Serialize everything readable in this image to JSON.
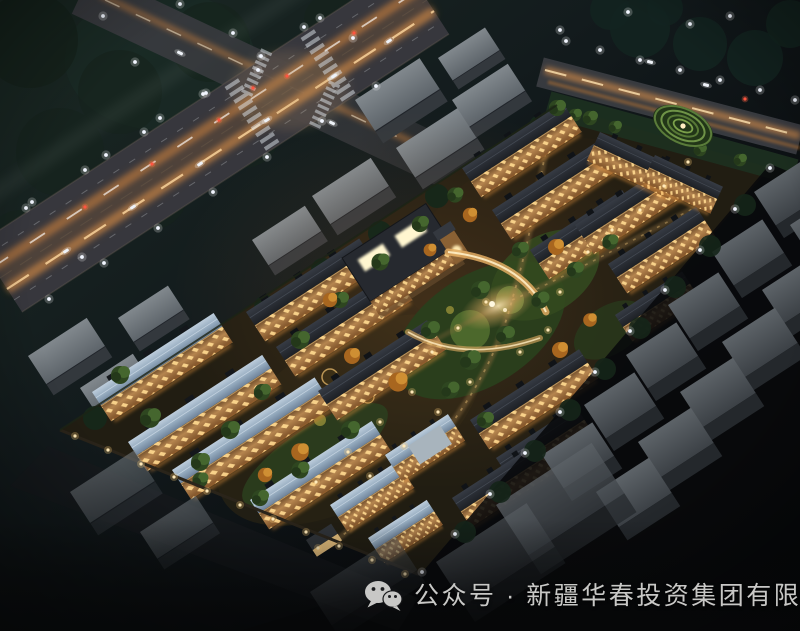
{
  "image_type": "aerial night-time architectural rendering (bird's-eye view) of a residential community",
  "watermark": {
    "icon": "wechat-icon",
    "text": "公众号 · 新疆华春投资集团有限公司",
    "text_color": "#c8c8c6"
  },
  "palette": {
    "watermark_color": "#c8c8c6",
    "sky_top": "#1b2a24",
    "sky_mid": "#121a1c",
    "ground_black": "#060708",
    "road_asphalt": "#3a393f",
    "road_glow": "#ef9a4a",
    "light_trail": "#ffd9a0",
    "facade_warm": "#b5854f",
    "window_glow": "#ffd98f",
    "roof_dark": "#262a31",
    "roof_blue": "#9db2c7",
    "tree_green": "#3a5427",
    "tree_dark": "#15231c",
    "tree_autumn": "#c07a28",
    "context_roof": "#6f767b",
    "context_face": "#33383d",
    "slab_roof": "#50565b",
    "wall_light": "#ffe2a2",
    "street_light": "#f2f6ff"
  },
  "scene": {
    "setting": "night aerial view of a gated residential compound surrounded by city streets and unlit context buildings",
    "community_features": [
      "townhouse rows with warm lit facades",
      "blue-gray metal roofs on the southwest clusters",
      "dark slate roofs on the other clusters",
      "central clubhouse with glowing skylights and tower",
      "curved colonnade embracing a lit plaza",
      "landscaped gardens with green and autumn-orange trees",
      "spiral hedge garden near the northeast edge",
      "perimeter wall lined with lanterns",
      "south gatehouse"
    ],
    "surroundings": [
      "main arterial road with car light trails running from lower-left to top",
      "cross street with zebra crosswalks at a lit intersection (upper-left)",
      "boulevard with street lamps along the northeast edge",
      "rows of dim gray buildings outside the community",
      "dark tree masses and scattered white street lights"
    ]
  }
}
